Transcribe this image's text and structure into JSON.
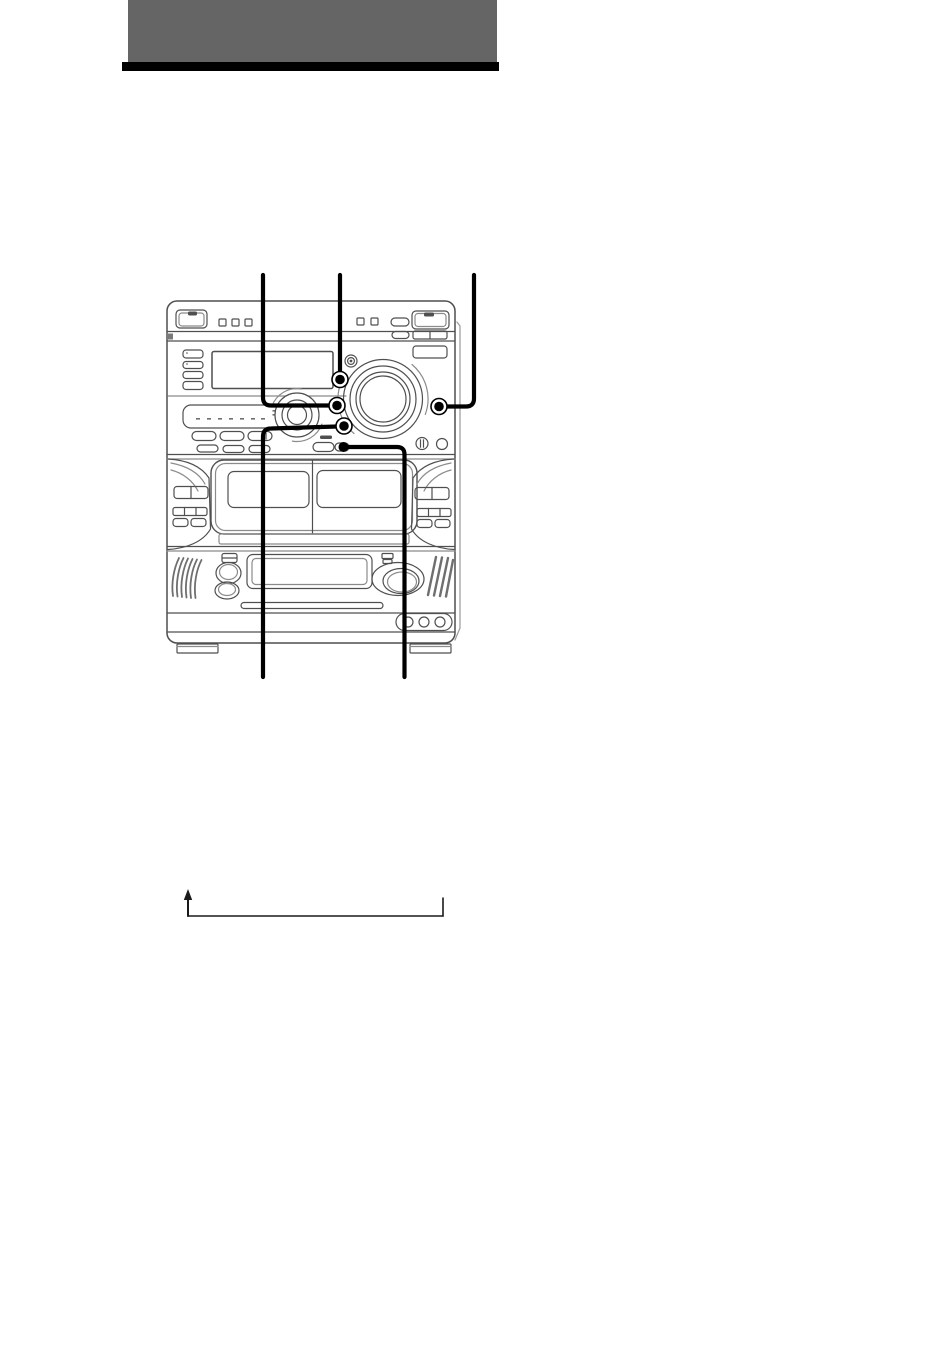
{
  "page": {
    "background": "#ffffff",
    "width": 950,
    "height": 1346
  },
  "header": {
    "title_band_color": "#666565",
    "rule_color": "#000000"
  },
  "figure": {
    "kind": "line-art-illustration",
    "subject": "mini-hifi-system-front-panel",
    "stroke_color": "#4f4f4f",
    "light_stroke_color": "#8b8b8b",
    "callout_color": "#000000",
    "parts": [
      "power-button",
      "top-panel-buttons",
      "display-window",
      "display-side-buttons",
      "jog-dial",
      "volume-knob",
      "cd-tray",
      "function-buttons",
      "callout-dot-a",
      "callout-dot-b",
      "callout-dot-c",
      "callout-dot-d",
      "callout-dot-e",
      "headphones-jack",
      "mic-jack",
      "cassette-deck-a-door",
      "cassette-deck-b-door",
      "deck-side-buttons",
      "bass-knobs",
      "bottom-opening",
      "master-knob",
      "speaker-vent-left",
      "speaker-vent-right",
      "indicator-circles",
      "feet"
    ],
    "callouts": [
      {
        "id": "callout-a",
        "route": "from top edge down-left column to button left of volume knob"
      },
      {
        "id": "callout-b",
        "route": "from top edge straight down to round button above jog dial"
      },
      {
        "id": "callout-c",
        "route": "from top edge down-right column to button right of volume knob"
      },
      {
        "id": "callout-d",
        "route": "from round button below jog dial, left then down past bottom of unit"
      },
      {
        "id": "callout-e",
        "route": "from small oval button, right then down past bottom of unit"
      }
    ]
  },
  "loop_diagram": {
    "shape": "return-arrow-bracket",
    "line_color": "#1a1a1a"
  }
}
